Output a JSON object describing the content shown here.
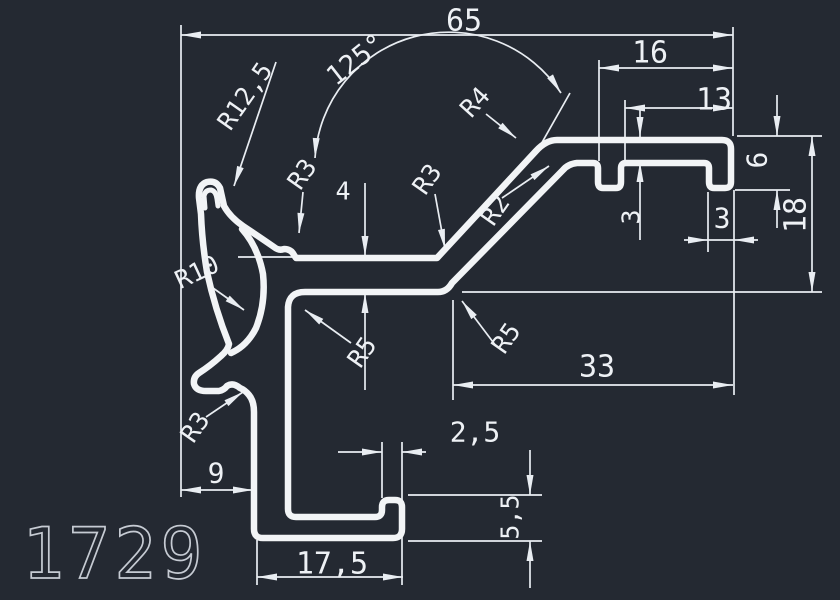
{
  "drawing": {
    "part_number": "1729",
    "type": "aluminium-extrusion-profile-cross-section"
  },
  "colors": {
    "background": "#242932",
    "line": "#f2f4f6",
    "dimension_line": "#e9edf2",
    "part_number_text": "#c6cbd3"
  },
  "labels": {
    "d65": "65",
    "d16": "16",
    "d13": "13",
    "d33": "33",
    "d9": "9",
    "d17_5": "17,5",
    "d2_5": "2,5",
    "d5_5": "5,5",
    "d18": "18",
    "d6": "6",
    "d4": "4",
    "d3_flange": "3",
    "d3_tooth": "3",
    "angle": "125°",
    "r12_5": "R12,5",
    "r10": "R10",
    "r4": "R4",
    "r2": "R2",
    "r3_top": "R3",
    "r3_mid": "R3",
    "r3_bottom": "R3",
    "r5_bend": "R5",
    "r5_fillet": "R5",
    "part_number": "1729"
  }
}
